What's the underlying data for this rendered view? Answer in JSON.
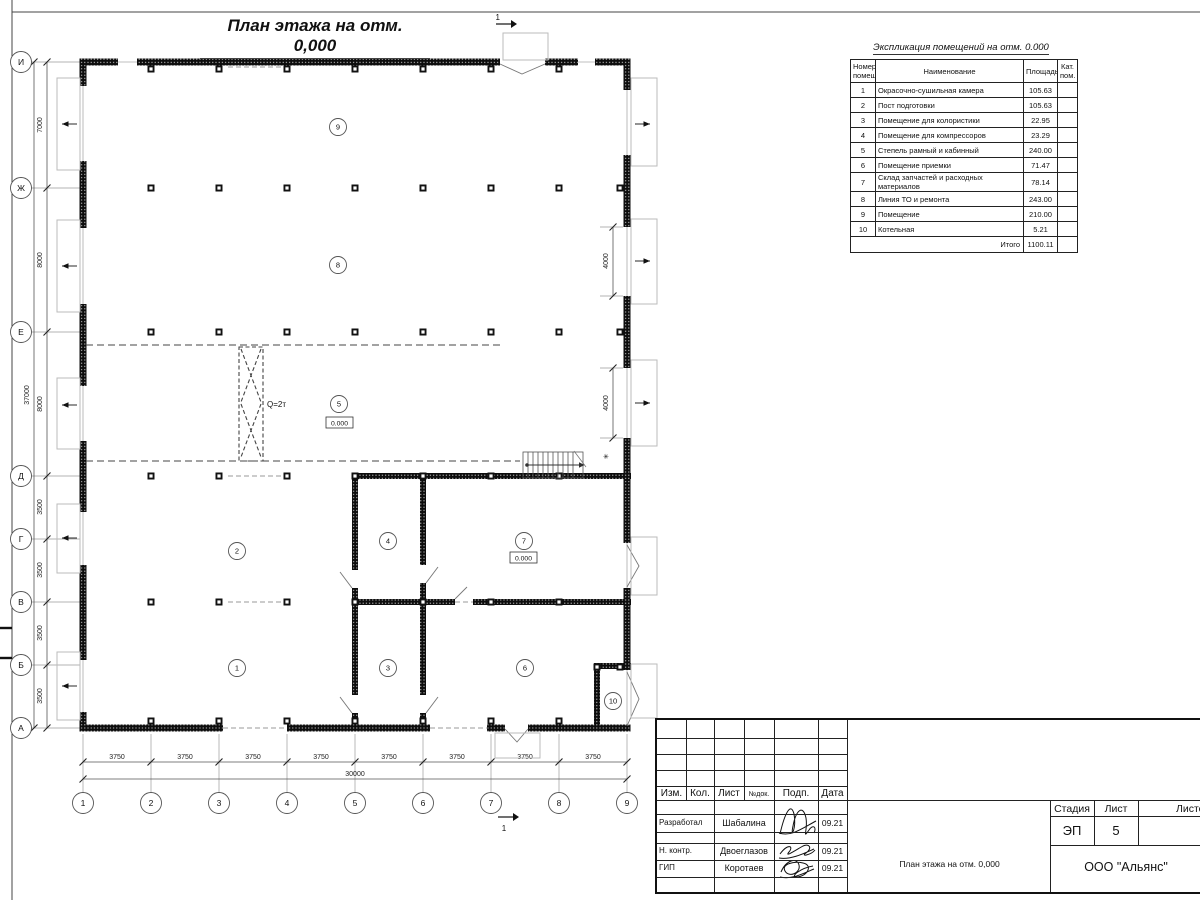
{
  "plan": {
    "title": "План этажа на отм. 0,000",
    "rooms": [
      "1",
      "2",
      "3",
      "4",
      "5",
      "6",
      "7",
      "8",
      "9",
      "10"
    ],
    "elevation": "0.000",
    "crane_capacity": "Q=2т",
    "note_mark": "✳",
    "section_mark": "1"
  },
  "axes": {
    "vertical_labels": [
      "И",
      "Ж",
      "Е",
      "Д",
      "Г",
      "В",
      "Б",
      "А"
    ],
    "vertical_dims": [
      "7000",
      "8000",
      "8000",
      "3500",
      "3500",
      "3500",
      "3500"
    ],
    "vertical_total": "37000",
    "horizontal_labels": [
      "1",
      "2",
      "3",
      "4",
      "5",
      "6",
      "7",
      "8",
      "9"
    ],
    "horizontal_dims": [
      "3750",
      "3750",
      "3750",
      "3750",
      "3750",
      "3750",
      "3750",
      "3750"
    ],
    "horizontal_total": "30000",
    "gate_dims": [
      "4000",
      "4000"
    ]
  },
  "schedule": {
    "title": "Экспликация помещений на отм. 0.000",
    "col_num": "Номер помещ.",
    "col_name": "Наименование",
    "col_area": "Площадь",
    "col_cat": "Кат. пом.",
    "rows": [
      {
        "num": "1",
        "name": "Окрасочно-сушильная камера",
        "area": "105.63",
        "cat": ""
      },
      {
        "num": "2",
        "name": "Пост подготовки",
        "area": "105.63",
        "cat": ""
      },
      {
        "num": "3",
        "name": "Помещение для колористики",
        "area": "22.95",
        "cat": ""
      },
      {
        "num": "4",
        "name": "Помещение для компрессоров",
        "area": "23.29",
        "cat": ""
      },
      {
        "num": "5",
        "name": "Степель рамный и кабинный",
        "area": "240.00",
        "cat": ""
      },
      {
        "num": "6",
        "name": "Помещение приемки",
        "area": "71.47",
        "cat": ""
      },
      {
        "num": "7",
        "name": "Склад запчастей и расходных материалов",
        "area": "78.14",
        "cat": ""
      },
      {
        "num": "8",
        "name": "Линия ТО и ремонта",
        "area": "243.00",
        "cat": ""
      },
      {
        "num": "9",
        "name": "Помещение",
        "area": "210.00",
        "cat": ""
      },
      {
        "num": "10",
        "name": "Котельная",
        "area": "5.21",
        "cat": ""
      }
    ],
    "total_label": "Итого",
    "total_area": "1100.11"
  },
  "titleblock": {
    "col_izm": "Изм.",
    "col_kol": "Кол.",
    "col_list": "Лист",
    "col_doc": "№док.",
    "col_sign": "Подп.",
    "col_date": "Дата",
    "rows": [
      {
        "role": "Разработал",
        "name": "Шабалина",
        "date": "09.21"
      },
      {
        "role": "Н. контр.",
        "name": "Двоеглазов",
        "date": "09.21"
      },
      {
        "role": "ГИП",
        "name": "Коротаев",
        "date": "09.21"
      }
    ],
    "stage_label": "Стадия",
    "sheet_label": "Лист",
    "sheets_label": "Листов",
    "stage": "ЭП",
    "sheet": "5",
    "doc_title": "План этажа на отм. 0,000",
    "company": "ООО \"Альянс\""
  }
}
